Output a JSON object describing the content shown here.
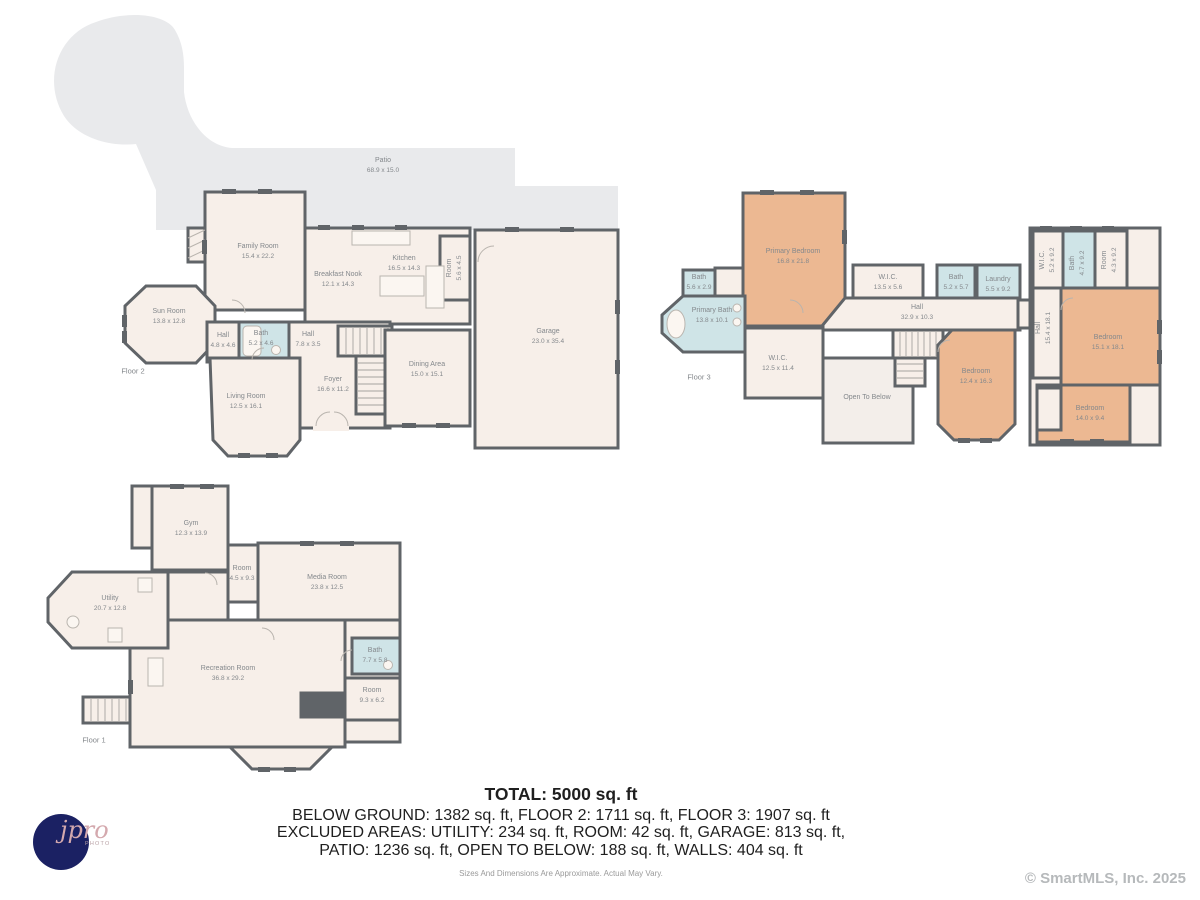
{
  "colors": {
    "wall": "#606468",
    "room_fill": "#f7efe9",
    "patio_fill": "#e9eaec",
    "bath_fill": "#cfe4e7",
    "bedroom_fill": "#ecb892",
    "label_text": "#84888c",
    "summary_text": "#1f1f1f",
    "disclaimer_text": "#9a9a9a",
    "copyright_text": "#b6b9bb",
    "logo_background": "#1b2163"
  },
  "floor2": {
    "floor_label": "Floor 2",
    "rooms": [
      {
        "name": "Patio",
        "dims": "68.9 x 15.0"
      },
      {
        "name": "Family Room",
        "dims": "15.4 x 22.2"
      },
      {
        "name": "Sun Room",
        "dims": "13.8 x 12.8"
      },
      {
        "name": "Breakfast Nook",
        "dims": "12.1 x 14.3"
      },
      {
        "name": "Kitchen",
        "dims": "16.5 x 14.3"
      },
      {
        "name": "Room",
        "dims": "5.6 x 4.5"
      },
      {
        "name": "Hall",
        "dims": "4.8 x 4.6"
      },
      {
        "name": "Bath",
        "dims": "5.2 x 4.6"
      },
      {
        "name": "Hall",
        "dims": "7.8 x 3.5"
      },
      {
        "name": "Dining Area",
        "dims": "15.0 x 15.1"
      },
      {
        "name": "Foyer",
        "dims": "16.6 x 11.2"
      },
      {
        "name": "Living Room",
        "dims": "12.5 x 16.1"
      },
      {
        "name": "Garage",
        "dims": "23.0 x 35.4"
      }
    ]
  },
  "floor3": {
    "floor_label": "Floor 3",
    "rooms": [
      {
        "name": "Primary Bedroom",
        "dims": "16.8 x 21.8"
      },
      {
        "name": "Bath",
        "dims": "5.6 x 2.9"
      },
      {
        "name": "Primary Bath",
        "dims": "13.8 x 10.1"
      },
      {
        "name": "W.I.C.",
        "dims": "13.5 x 5.6"
      },
      {
        "name": "Bath",
        "dims": "5.2 x 5.7"
      },
      {
        "name": "Laundry",
        "dims": "5.5 x 9.2"
      },
      {
        "name": "Hall",
        "dims": "32.9 x 10.3"
      },
      {
        "name": "W.I.C.",
        "dims": "12.5 x 11.4"
      },
      {
        "name": "Open To Below",
        "dims": ""
      },
      {
        "name": "Bedroom",
        "dims": "12.4 x 16.3"
      },
      {
        "name": "W.I.C.",
        "dims": "5.2 x 9.2"
      },
      {
        "name": "Bath",
        "dims": "4.7 x 9.2"
      },
      {
        "name": "Room",
        "dims": "4.3 x 9.2"
      },
      {
        "name": "Hall",
        "dims": "15.4 x 18.1"
      },
      {
        "name": "Bedroom",
        "dims": "15.1 x 18.1"
      },
      {
        "name": "Bedroom",
        "dims": "14.0 x 9.4"
      }
    ]
  },
  "floor1": {
    "floor_label": "Floor 1",
    "rooms": [
      {
        "name": "Gym",
        "dims": "12.3 x 13.9"
      },
      {
        "name": "Room",
        "dims": "4.5 x 9.3"
      },
      {
        "name": "Media Room",
        "dims": "23.8 x 12.5"
      },
      {
        "name": "Utility",
        "dims": "20.7 x 12.8"
      },
      {
        "name": "Recreation Room",
        "dims": "36.8 x 29.2"
      },
      {
        "name": "Bath",
        "dims": "7.7 x 5.8"
      },
      {
        "name": "Room",
        "dims": "9.3 x 6.2"
      }
    ]
  },
  "summary": {
    "total": "TOTAL: 5000 sq. ft",
    "line1": "BELOW GROUND: 1382 sq. ft, FLOOR 2: 1711 sq. ft, FLOOR 3: 1907 sq. ft",
    "line2": "EXCLUDED AREAS: UTILITY: 234 sq. ft, ROOM: 42 sq. ft, GARAGE: 813 sq. ft,",
    "line3": "PATIO: 1236 sq. ft, OPEN TO BELOW: 188 sq. ft, WALLS: 404 sq. ft",
    "disclaimer": "Sizes And Dimensions Are Approximate. Actual May Vary."
  },
  "logo": {
    "script": "jpro",
    "sub": "PHOTO"
  },
  "copyright": "© SmartMLS, Inc.  2025"
}
